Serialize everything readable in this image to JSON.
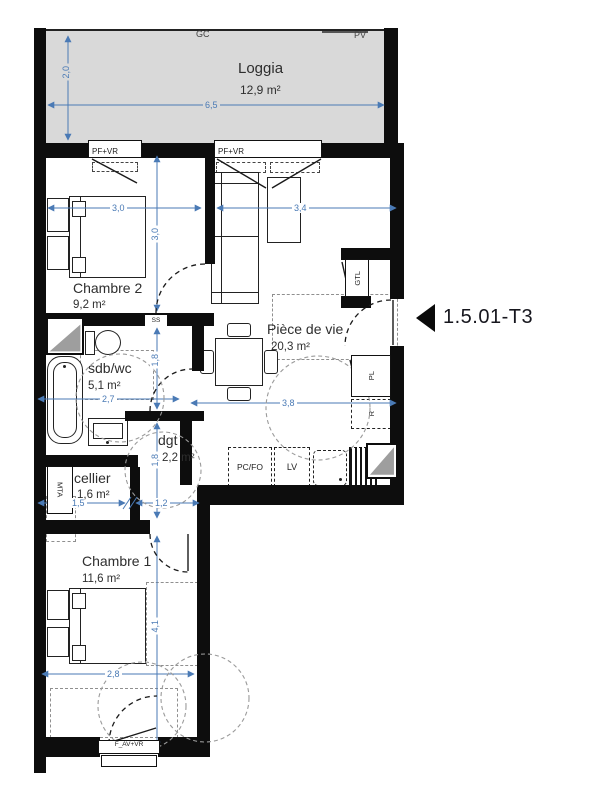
{
  "unit": {
    "label": "1.5.01-T3"
  },
  "loggia": {
    "name": "Loggia",
    "area": "12,9 m²",
    "gc": "GC",
    "pv": "PV",
    "height_dim": "2,0",
    "width_dim": "6,5"
  },
  "windows": {
    "pfvr_left": "PF+VR",
    "pfvr_right": "PF+VR",
    "bottom": "F_AV+VR"
  },
  "chambre2": {
    "name": "Chambre 2",
    "area": "9,2 m²",
    "width_dim": "3,0",
    "height_dim": "3,0"
  },
  "living": {
    "name": "Pièce de vie",
    "area": "20,3 m²",
    "width_dim": "3,4",
    "kitchen_dim": "3,8"
  },
  "sdb": {
    "name": "sdb/wc",
    "area": "5,1 m²",
    "height_dim": "1,8",
    "width_dim": "2,7",
    "ss": "SS"
  },
  "dgt": {
    "name": "dgt",
    "area": "2,2 m²",
    "height_dim": "1,8",
    "width_dim": "1,2"
  },
  "cellier": {
    "name": "cellier",
    "area": "1,6 m²",
    "width_dim": "1,5",
    "mta": "MTA"
  },
  "chambre1": {
    "name": "Chambre 1",
    "area": "11,6 m²",
    "height_dim": "4,1",
    "width_dim": "2,8"
  },
  "kitchen": {
    "pcfo": "PC/FO",
    "lv": "LV"
  },
  "fixtures": {
    "gtl": "GTL",
    "pl": "PL",
    "r": "R"
  },
  "colors": {
    "dim_blue": "#4a7ab5",
    "wall": "#0d0d0d",
    "loggia_fill": "#d9d9d9",
    "shaft_fill": "#9e9e9e"
  }
}
